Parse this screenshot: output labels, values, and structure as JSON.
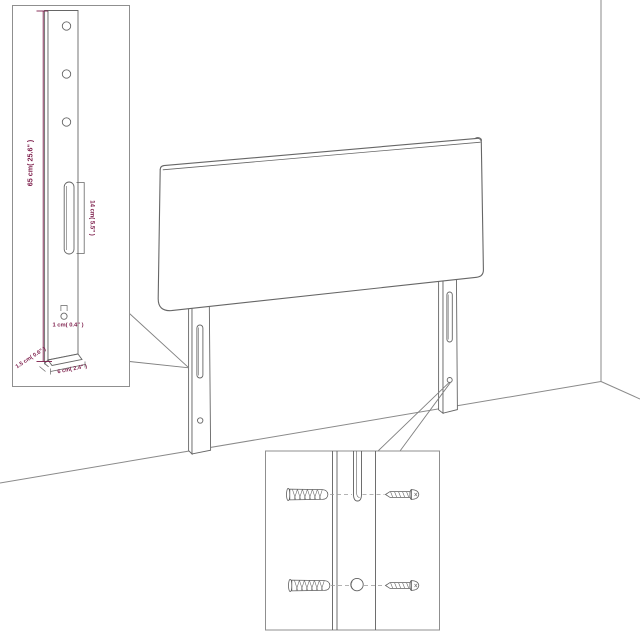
{
  "diagram": {
    "subject": "headboard-with-two-mounting-legs-in-room-corner",
    "colors": {
      "outline": "#666666",
      "inset_border": "#8f8f8f",
      "dimension": "#7d1e4b",
      "dash": "#9a9a9a",
      "background": "#ffffff"
    },
    "leg_detail_inset": {
      "hole_count": 3,
      "labels": {
        "leg_height": "65 cm( 25.6\" )",
        "slot_length": "14 cm( 5.5\" )",
        "hole_size": "1 cm( 0.4\" )",
        "leg_depth": "1.5 cm( 0.6\" )",
        "leg_width": "6 cm( 2.4\" )"
      }
    },
    "mounting_inset": {
      "rows": 2,
      "hardware": [
        "wall-plug-icon",
        "screw-icon"
      ]
    }
  }
}
